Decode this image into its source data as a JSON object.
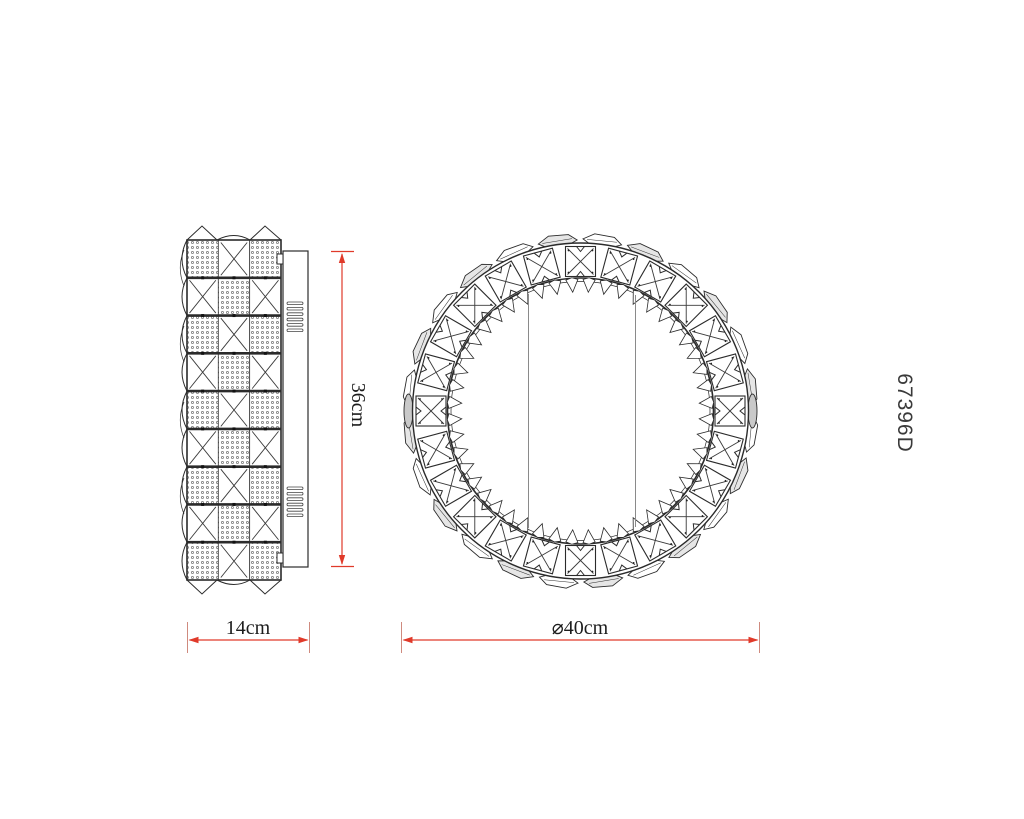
{
  "product": {
    "code": "67396D"
  },
  "dimensions": {
    "height_label": "36cm",
    "width_label": "14cm",
    "diameter_label": "⌀40cm"
  },
  "colors": {
    "line": "#2b2b2b",
    "thin_line": "#3a3a3a",
    "dimension_red": "#e03a2a",
    "tick_red": "#cf8a7e",
    "chord_gray": "#8a8a8a",
    "crystal_gray": "#e6e6e6",
    "lens_gray": "#c9c9c9",
    "dot_gray": "#555555"
  },
  "geometry": {
    "side_view": {
      "panel": {
        "x": 187,
        "y": 240,
        "w": 94,
        "h": 340,
        "cols": 3,
        "rows": 9
      },
      "plate": {
        "x": 283,
        "y": 251,
        "w": 25,
        "h": 316
      },
      "tabs": [
        {
          "x": 277,
          "y": 254,
          "w": 6,
          "h": 10
        },
        {
          "x": 277,
          "y": 553,
          "w": 6,
          "h": 10
        }
      ],
      "vents": {
        "x": 287,
        "w": 16,
        "h": 2.6,
        "count": 6,
        "spacing": 5.4,
        "groups_y": [
          302,
          487
        ]
      }
    },
    "front_view": {
      "cx": 580.5,
      "cy": 411,
      "outer_r": 168,
      "band_inner_r": 133,
      "band_inner_r2": 129.5,
      "squares": {
        "count": 24,
        "size": 30,
        "center_r": 149.5
      },
      "teeth": {
        "count": 48,
        "base_r": 131.5,
        "tip_r": 119,
        "half_base": 6,
        "angle_offset": 3.75
      },
      "gems": {
        "count": 24,
        "angle_offset": 7.5,
        "ring_y_off": 173
      },
      "lens": {
        "r_offset": 172,
        "rx": 4.5,
        "ry": 17
      },
      "chords": [
        {
          "x": 528.5,
          "y1": 294,
          "y2": 528
        },
        {
          "x": 635.5,
          "y1": 295,
          "y2": 527
        }
      ]
    },
    "dims": {
      "height": {
        "x": 342,
        "y1": 252,
        "y2": 566,
        "tick_x1": 331,
        "tick_x2": 354
      },
      "width": {
        "y": 640,
        "x1": 187.5,
        "x2": 309.5,
        "tick_y1": 622,
        "tick_y2": 653
      },
      "diameter": {
        "y": 640,
        "x1": 401.5,
        "x2": 759.5,
        "tick_y1": 622,
        "tick_y2": 653
      }
    }
  }
}
